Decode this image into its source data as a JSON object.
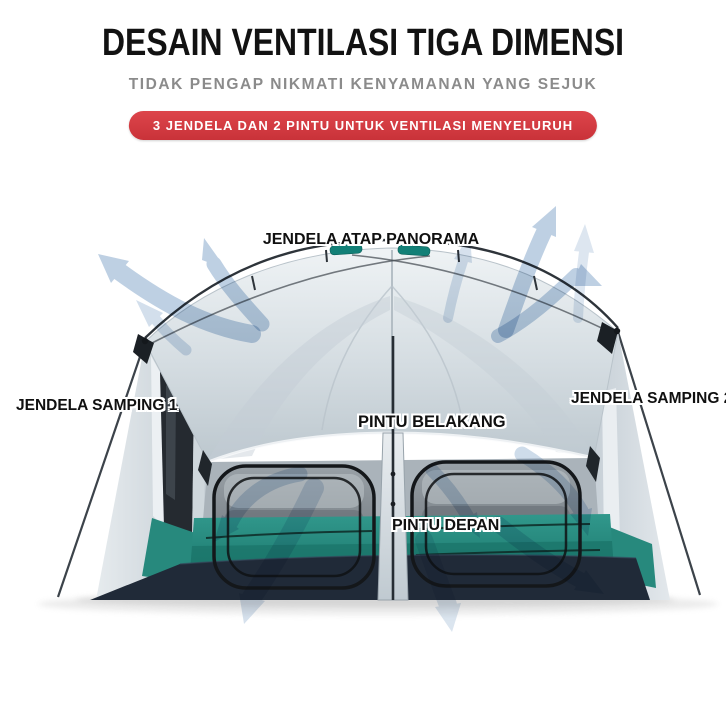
{
  "header": {
    "title": "DESAIN VENTILASI TIGA DIMENSI",
    "subtitle": "TIDAK PENGAP NIKMATI KENYAMANAN YANG SEJUK",
    "badge_label": "3 JENDELA DAN 2 PINTU UNTUK VENTILASI MENYELURUH"
  },
  "diagram": {
    "labels": {
      "roof_window": "JENDELA ATAP PANORAMA",
      "side_window_1": "JENDELA SAMPING 1",
      "side_window_2": "JENDELA SAMPING 2",
      "back_door": "PINTU BELAKANG",
      "front_door": "PINTU DEPAN"
    },
    "icons": {
      "airflow_arrows": "curved-airflow-arrow"
    },
    "colors": {
      "badge_red": "#d23a40",
      "arrow_blue": "#aec4dc",
      "tent_fly_gray": "#d7dee3",
      "tent_mesh_gray": "#878f95",
      "tent_teal": "#2a8e83",
      "tent_skirt_navy": "#202a38",
      "subtitle_gray": "#8b8b8b",
      "label_text": "#101010"
    }
  }
}
